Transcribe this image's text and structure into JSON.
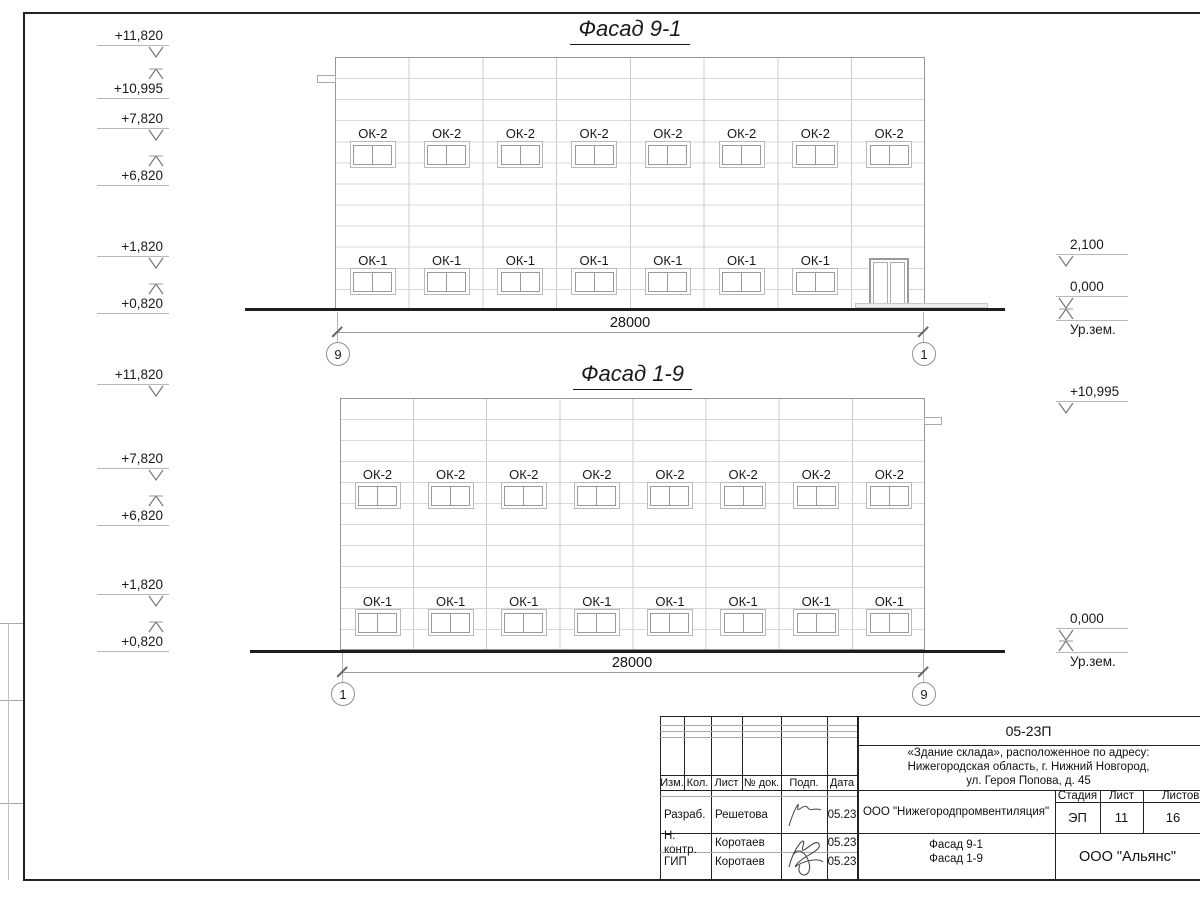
{
  "f1": {
    "title": "Фасад 9-1",
    "ok2": "ОК-2",
    "ok1": "ОК-1",
    "dim": "28000",
    "axisL": "9",
    "axisR": "1",
    "e11820": "+11,820",
    "e10995": "+10,995",
    "e7820": "+7,820",
    "e6820": "+6,820",
    "e1820": "+1,820",
    "e0820": "+0,820",
    "r2100": "2,100",
    "r0000": "0,000",
    "ground": "Ур.зем."
  },
  "f2": {
    "title": "Фасад 1-9",
    "ok2": "ОК-2",
    "ok1": "ОК-1",
    "dim": "28000",
    "axisL": "1",
    "axisR": "9",
    "e11820": "+11,820",
    "e7820": "+7,820",
    "e6820": "+6,820",
    "e1820": "+1,820",
    "e0820": "+0,820",
    "r10995": "+10,995",
    "r0000": "0,000",
    "ground": "Ур.зем."
  },
  "sheet": {
    "code": "05-23П",
    "addr": [
      "«Здание склада», расположенное по адресу:",
      "Нижегородская область, г. Нижний Новгород,",
      "ул. Героя Попова, д. 45"
    ],
    "org": "ООО \"Нижегородпромвентиляция\"",
    "stage_label": "Стадия",
    "sheet_label": "Лист",
    "sheets_label": "Листов",
    "stage": "ЭП",
    "sheet_no": "11",
    "sheets_total": "16",
    "title_line1": "Фасад 9-1",
    "title_line2": "Фасад 1-9",
    "company": "ООО \"Альянс\"",
    "cols": {
      "izm": "Изм.",
      "kol": "Кол.",
      "list": "Лист",
      "doc": "№ док.",
      "podp": "Подп.",
      "data": "Дата"
    },
    "rows": [
      {
        "role": "Разраб.",
        "name": "Решетова",
        "date": "05.23"
      },
      {
        "role": "Н. контр.",
        "name": "Коротаев",
        "date": "05.23"
      },
      {
        "role": "ГИП",
        "name": "Коротаев",
        "date": "05.23"
      }
    ]
  }
}
